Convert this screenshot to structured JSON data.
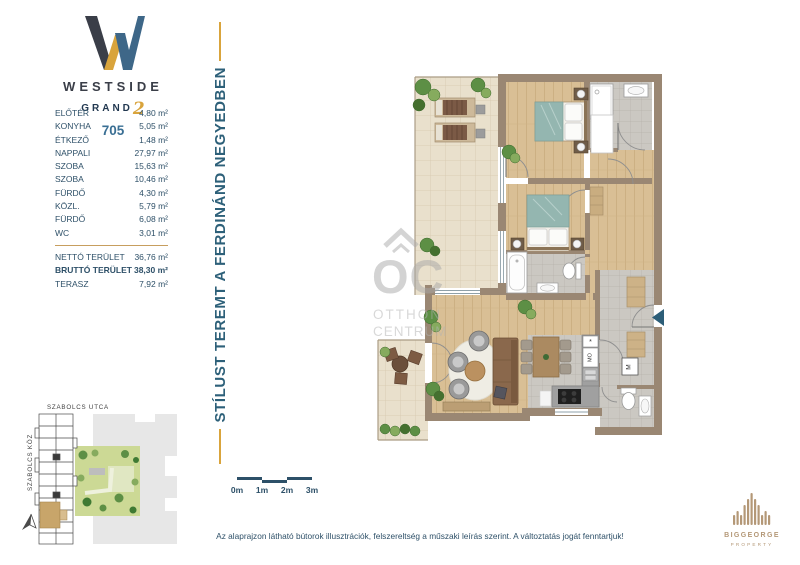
{
  "branding": {
    "project": "WESTSIDE",
    "line2": "GRAND",
    "line2_number": "2",
    "unit_number": "705"
  },
  "tagline": "STÍLUST TEREMT A FERDINÁND NEGYEDBEN",
  "left_panel": {
    "rooms": [
      {
        "label": "ELŐTÉR",
        "area": "4,80 m²"
      },
      {
        "label": "KONYHA",
        "area": "5,05 m²"
      },
      {
        "label": "ÉTKEZŐ",
        "area": "1,48 m²"
      },
      {
        "label": "NAPPALI",
        "area": "27,97 m²"
      },
      {
        "label": "SZOBA",
        "area": "15,63 m²"
      },
      {
        "label": "SZOBA",
        "area": "10,46 m²"
      },
      {
        "label": "FÜRDŐ",
        "area": "4,30 m²"
      },
      {
        "label": "KÖZL.",
        "area": "5,79 m²"
      },
      {
        "label": "FÜRDŐ",
        "area": "6,08 m²"
      },
      {
        "label": "WC",
        "area": "3,01 m²"
      }
    ],
    "totals": [
      {
        "label": "NETTÓ TERÜLET",
        "area": "36,76 m²",
        "bold": false
      },
      {
        "label": "BRUTTÓ TERÜLET",
        "area": "38,30 m²",
        "bold": true
      },
      {
        "label": "TERASZ",
        "area": "7,92 m²",
        "bold": false
      }
    ]
  },
  "site_map": {
    "street_top": "SZABOLCS UTCA",
    "street_left": "SZABOLCS KÖZ"
  },
  "floor_plan": {
    "labels": {
      "shaft": "M",
      "washer": "MO",
      "fridge": "*"
    },
    "watermark": {
      "initials": "OC",
      "line1": "OTTHON",
      "line2": "CENTRUM"
    }
  },
  "scale_bar": {
    "labels": [
      "0m",
      "1m",
      "2m",
      "3m"
    ]
  },
  "footer": {
    "disclaimer": "Az alaprajzon látható bútorok illusztrációk, felszereltség a műszaki leírás szerint. A változtatás jogát fenntartjuk!"
  },
  "developer": {
    "name": "BIGGEORGE",
    "subtitle": "PROPERTY"
  },
  "colors": {
    "navy": "#2e5068",
    "blue": "#3a6f94",
    "gold": "#d9a43c",
    "wall": "#9a8773",
    "arrow": "#2d5e78"
  }
}
